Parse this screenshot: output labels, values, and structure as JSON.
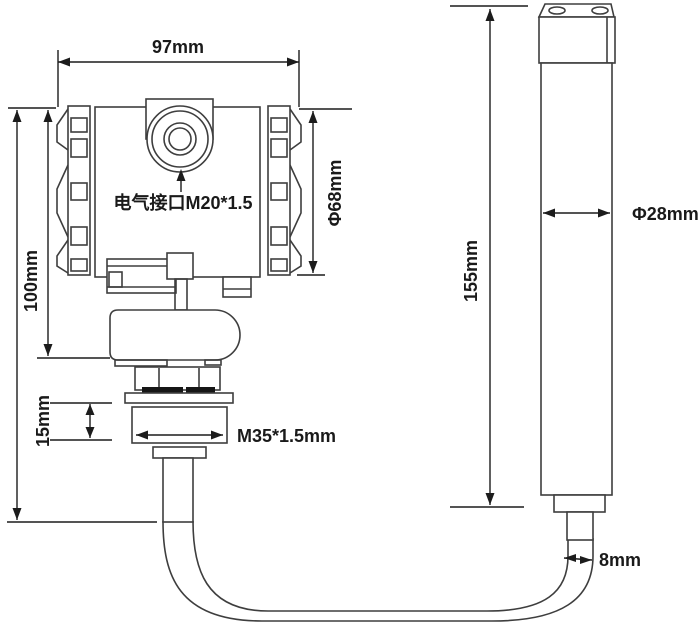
{
  "diagram": {
    "kind": "technical-dimension-drawing",
    "subject": "pressure level transmitter with submersible probe and cable",
    "background": "#ffffff",
    "colors": {
      "structure_line": "#3e3e3e",
      "dimension_line": "#1c1c1c",
      "text": "#1a1a1a",
      "pad_fill": "#161616"
    },
    "annotations": {
      "housing_width": "97mm",
      "housing_height": "100mm",
      "housing_diameter": "Φ68mm",
      "electrical_interface": "电气接口M20*1.5",
      "process_thread": "M35*1.5mm",
      "thread_section_height": "15mm",
      "probe_length": "155mm",
      "probe_diameter": "Φ28mm",
      "cable_diameter": "8mm"
    },
    "parts": [
      "transmitter-housing",
      "electrical-port",
      "side-cover-left",
      "side-cover-right",
      "terminal-bracket",
      "oval-process-connection",
      "mounting-flange",
      "thread-nut",
      "conduit-tube",
      "cable",
      "probe-body",
      "probe-cap",
      "probe-neck"
    ]
  }
}
